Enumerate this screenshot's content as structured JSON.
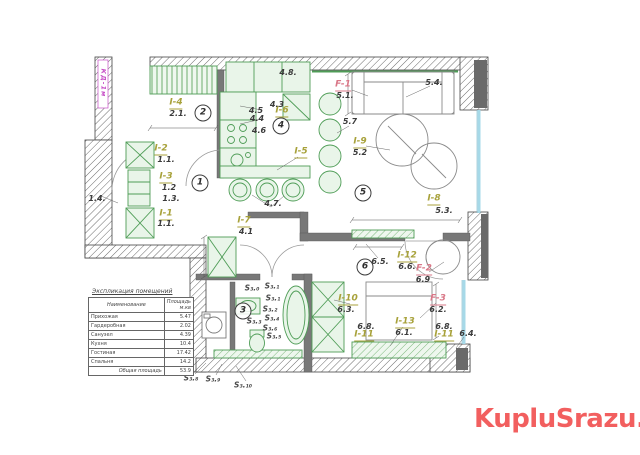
{
  "watermark": {
    "text": "KupluSrazu.ru",
    "color": "#f25f5f"
  },
  "table": {
    "title": "Экспликация помещений",
    "columns": [
      "Наименование",
      "Площадь м.кв"
    ],
    "rows": [
      [
        "Прихожая",
        "5.47"
      ],
      [
        "Гардеробная",
        "2.02"
      ],
      [
        "Санузел",
        "4.39"
      ],
      [
        "Кухня",
        "10.4"
      ],
      [
        "Гостиная",
        "17.42"
      ],
      [
        "Спальня",
        "14.2"
      ]
    ],
    "footer": {
      "label": "Общая площадь",
      "value": "53.9"
    }
  },
  "plan": {
    "colors": {
      "furniture_label_green": "#a8a23b",
      "fixture_label_pink": "#d97787",
      "area_value_text": "#3b3b3b",
      "window_glass": "#a6d9e8",
      "furniture_outline": "#4f9d57",
      "shaft_label_magenta": "#c74fc7"
    },
    "labels": [
      {
        "t": "I-4",
        "x": 176,
        "y": 104,
        "c": "green",
        "n": "label-i-4"
      },
      {
        "t": "2.1.",
        "x": 178,
        "y": 114,
        "c": "val",
        "n": "area-2-1"
      },
      {
        "t": "I-2",
        "x": 161,
        "y": 150,
        "c": "green",
        "n": "label-i-2"
      },
      {
        "t": "1.1.",
        "x": 166,
        "y": 160,
        "c": "val",
        "n": "area-1-1"
      },
      {
        "t": "I-3",
        "x": 166,
        "y": 178,
        "c": "green",
        "n": "label-i-3"
      },
      {
        "t": "1.2",
        "x": 169,
        "y": 188,
        "c": "val",
        "n": "area-1-2"
      },
      {
        "t": "1.3.",
        "x": 171,
        "y": 199,
        "c": "val",
        "n": "area-1-3"
      },
      {
        "t": "1.4.",
        "x": 97,
        "y": 199,
        "c": "val",
        "n": "area-1-4"
      },
      {
        "t": "I-1",
        "x": 166,
        "y": 215,
        "c": "green",
        "n": "label-i-1"
      },
      {
        "t": "1.1.",
        "x": 166,
        "y": 224,
        "c": "val",
        "n": "area-1-1b"
      },
      {
        "t": "I-7",
        "x": 244,
        "y": 222,
        "c": "green",
        "n": "label-i-7"
      },
      {
        "t": "4.1",
        "x": 246,
        "y": 232,
        "c": "val",
        "n": "area-4-1"
      },
      {
        "t": "I-6",
        "x": 282,
        "y": 112,
        "c": "green",
        "n": "label-i-6"
      },
      {
        "t": "4.3",
        "x": 277,
        "y": 105,
        "c": "val",
        "n": "area-4-3"
      },
      {
        "t": "4.5",
        "x": 256,
        "y": 111,
        "c": "val",
        "n": "area-4-5"
      },
      {
        "t": "4.4",
        "x": 257,
        "y": 119,
        "c": "val",
        "n": "area-4-4"
      },
      {
        "t": "4.6",
        "x": 259,
        "y": 131,
        "c": "val",
        "n": "area-4-6"
      },
      {
        "t": "4.8.",
        "x": 288,
        "y": 73,
        "c": "val",
        "n": "area-4-8"
      },
      {
        "t": "4.7.",
        "x": 273,
        "y": 204,
        "c": "val",
        "n": "area-4-7"
      },
      {
        "t": "I-5",
        "x": 301,
        "y": 153,
        "c": "green",
        "n": "label-i-5"
      },
      {
        "t": "F-1",
        "x": 343,
        "y": 86,
        "c": "pink",
        "n": "label-f-1"
      },
      {
        "t": "5.1.",
        "x": 345,
        "y": 96,
        "c": "val",
        "n": "area-5-1"
      },
      {
        "t": "5.4.",
        "x": 434,
        "y": 83,
        "c": "val",
        "n": "area-5-4"
      },
      {
        "t": "5.7",
        "x": 350,
        "y": 122,
        "c": "val",
        "n": "area-5-7"
      },
      {
        "t": "I-9",
        "x": 360,
        "y": 143,
        "c": "green",
        "n": "label-i-9"
      },
      {
        "t": "5.2",
        "x": 360,
        "y": 153,
        "c": "val",
        "n": "area-5-2"
      },
      {
        "t": "I-8",
        "x": 434,
        "y": 200,
        "c": "green",
        "n": "label-i-8"
      },
      {
        "t": "5.3.",
        "x": 444,
        "y": 211,
        "c": "val",
        "n": "area-5-3"
      },
      {
        "t": "6.5.",
        "x": 380,
        "y": 262,
        "c": "val",
        "n": "area-6-5"
      },
      {
        "t": "I-12",
        "x": 407,
        "y": 257,
        "c": "green",
        "n": "label-i-12"
      },
      {
        "t": "6.6.",
        "x": 407,
        "y": 267,
        "c": "val",
        "n": "area-6-6"
      },
      {
        "t": "F-2",
        "x": 424,
        "y": 270,
        "c": "pink",
        "n": "label-f-2"
      },
      {
        "t": "6.9",
        "x": 423,
        "y": 280,
        "c": "val",
        "n": "area-6-9"
      },
      {
        "t": "F-3",
        "x": 438,
        "y": 300,
        "c": "pink",
        "n": "label-f-3"
      },
      {
        "t": "6.2.",
        "x": 438,
        "y": 310,
        "c": "val",
        "n": "area-6-2"
      },
      {
        "t": "I-10",
        "x": 348,
        "y": 300,
        "c": "green",
        "n": "label-i-10"
      },
      {
        "t": "6.3.",
        "x": 346,
        "y": 310,
        "c": "val",
        "n": "area-6-3"
      },
      {
        "t": "6.8.",
        "x": 366,
        "y": 327,
        "c": "val",
        "n": "area-6-8a"
      },
      {
        "t": "I-11",
        "x": 364,
        "y": 336,
        "c": "green",
        "n": "label-i-11a"
      },
      {
        "t": "I-13",
        "x": 405,
        "y": 323,
        "c": "green",
        "n": "label-i-13"
      },
      {
        "t": "6.1.",
        "x": 404,
        "y": 333,
        "c": "val",
        "n": "area-6-1"
      },
      {
        "t": "6.8.",
        "x": 444,
        "y": 327,
        "c": "val",
        "n": "area-6-8b"
      },
      {
        "t": "I-11",
        "x": 444,
        "y": 336,
        "c": "green",
        "n": "label-i-11b"
      },
      {
        "t": "6.4.",
        "x": 468,
        "y": 334,
        "c": "val",
        "n": "area-6-4"
      },
      {
        "t": "1",
        "x": 200,
        "y": 183,
        "c": "circle",
        "n": "room-number-1"
      },
      {
        "t": "2",
        "x": 203,
        "y": 113,
        "c": "circle",
        "n": "room-number-2"
      },
      {
        "t": "3",
        "x": 243,
        "y": 311,
        "c": "circle",
        "n": "room-number-3"
      },
      {
        "t": "4",
        "x": 281,
        "y": 126,
        "c": "circle",
        "n": "room-number-4"
      },
      {
        "t": "5",
        "x": 363,
        "y": 193,
        "c": "circle",
        "n": "room-number-5"
      },
      {
        "t": "6",
        "x": 365,
        "y": 267,
        "c": "circle",
        "n": "room-number-6"
      },
      {
        "t": "S₃.₀",
        "x": 252,
        "y": 288,
        "c": "s",
        "n": "s-label-3-0"
      },
      {
        "t": "S₃.₁",
        "x": 272,
        "y": 286,
        "c": "s",
        "n": "s-label-3-1a"
      },
      {
        "t": "S₃.₁",
        "x": 273,
        "y": 298,
        "c": "s",
        "n": "s-label-3-1b"
      },
      {
        "t": "S₃.₂",
        "x": 270,
        "y": 309,
        "c": "s",
        "n": "s-label-3-2"
      },
      {
        "t": "S₃.₃",
        "x": 254,
        "y": 321,
        "c": "s",
        "n": "s-label-3-3"
      },
      {
        "t": "S₃.₄",
        "x": 272,
        "y": 318,
        "c": "s",
        "n": "s-label-3-4"
      },
      {
        "t": "S₃.₆",
        "x": 270,
        "y": 328,
        "c": "s",
        "n": "s-label-3-6"
      },
      {
        "t": "S₃.₅",
        "x": 274,
        "y": 336,
        "c": "s",
        "n": "s-label-3-5"
      },
      {
        "t": "S₃.₈",
        "x": 191,
        "y": 378,
        "c": "s",
        "n": "s-label-3-8"
      },
      {
        "t": "S₃.₉",
        "x": 213,
        "y": 379,
        "c": "s",
        "n": "s-label-3-9"
      },
      {
        "t": "S₃.₁₀",
        "x": 243,
        "y": 385,
        "c": "s",
        "n": "s-label-3-10"
      },
      {
        "t": "КД-1м",
        "x": 103,
        "y": 83,
        "c": "magenta",
        "n": "shaft-label"
      }
    ]
  }
}
